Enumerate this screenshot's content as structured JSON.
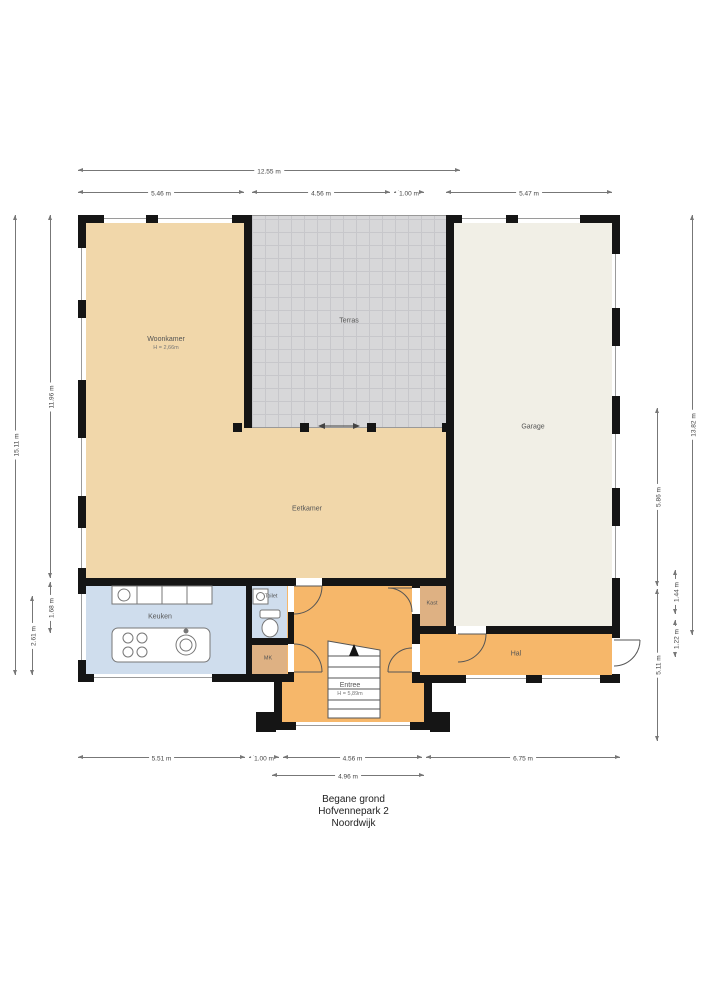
{
  "title": {
    "floor": "Begane grond",
    "address": "Hofvennepark 2",
    "city": "Noordwijk"
  },
  "rooms": {
    "woonkamer": {
      "name": "Woonkamer",
      "height": "H = 2,66m"
    },
    "terras": {
      "name": "Terras"
    },
    "garage": {
      "name": "Garage"
    },
    "eetkamer": {
      "name": "Eetkamer"
    },
    "keuken": {
      "name": "Keuken"
    },
    "toilet": {
      "name": "Toilet"
    },
    "mk": {
      "name": "MK"
    },
    "kast": {
      "name": "Kast"
    },
    "entree": {
      "name": "Entree",
      "height": "H = 5,89m"
    },
    "hal": {
      "name": "Hal"
    }
  },
  "dims": {
    "top_total": "12.55 m",
    "top_1": "5.46 m",
    "top_2": "4.56 m",
    "top_3": "1.00 m",
    "top_4": "5.47 m",
    "bottom_1": "5.51 m",
    "bottom_2": "1.00 m",
    "bottom_3": "4.56 m",
    "bottom_4": "6.75 m",
    "bottom_entree": "4.96 m",
    "left_total": "15.11 m",
    "left_1": "11.96 m",
    "left_2": "1.68 m",
    "left_3": "2.61 m",
    "right_total": "13.82 m",
    "right_1": "5.86 m",
    "right_2": "5.11 m",
    "right_3": "1.44 m",
    "right_4": "1.22 m"
  },
  "colors": {
    "wall": "#151515",
    "tan": "#f1d7aa",
    "terras": "#d7d7d9",
    "terrasgrid": "#c7c7cb",
    "garage": "#f1efe6",
    "blue": "#cfdded",
    "orange": "#f6b76a",
    "closet": "#deb183",
    "dim": "#777777",
    "dimtext": "#444444",
    "text": "#555555"
  }
}
